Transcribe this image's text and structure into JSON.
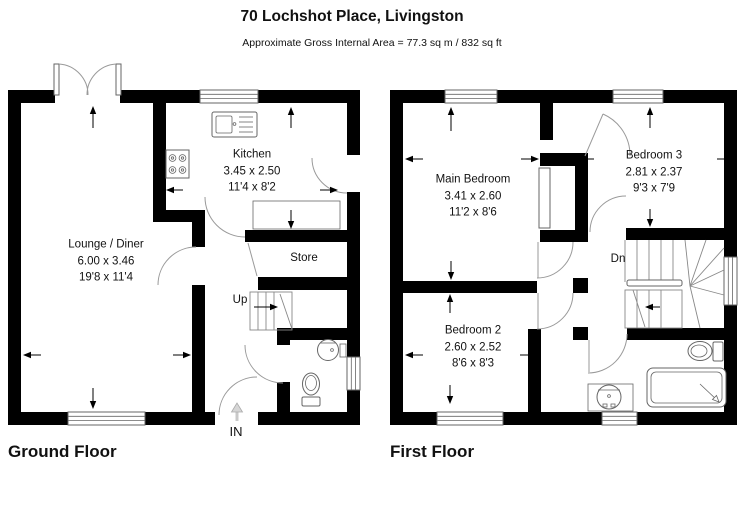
{
  "header": {
    "title": "70 Lochshot Place, Livingston",
    "subtitle": "Approximate Gross Internal Area = 77.3 sq m / 832 sq ft"
  },
  "ground_floor": {
    "label": "Ground Floor",
    "rooms": {
      "lounge": {
        "name": "Lounge / Diner",
        "metric": "6.00 x 3.46",
        "imperial": "19'8 x 11'4"
      },
      "kitchen": {
        "name": "Kitchen",
        "metric": "3.45 x 2.50",
        "imperial": "11'4 x 8'2"
      },
      "store": {
        "name": "Store"
      }
    },
    "annotations": {
      "up": "Up",
      "entrance": "IN"
    }
  },
  "first_floor": {
    "label": "First Floor",
    "rooms": {
      "main_bedroom": {
        "name": "Main Bedroom",
        "metric": "3.41 x 2.60",
        "imperial": "11'2 x 8'6"
      },
      "bedroom2": {
        "name": "Bedroom 2",
        "metric": "2.60 x 2.52",
        "imperial": "8'6 x 8'3"
      },
      "bedroom3": {
        "name": "Bedroom 3",
        "metric": "2.81 x 2.37",
        "imperial": "9'3 x 7'9"
      }
    },
    "annotations": {
      "dn": "Dn"
    }
  },
  "colors": {
    "wall": "#000000",
    "background": "#ffffff",
    "thin_line": "#666666",
    "door_arc": "#9a9a9a"
  }
}
